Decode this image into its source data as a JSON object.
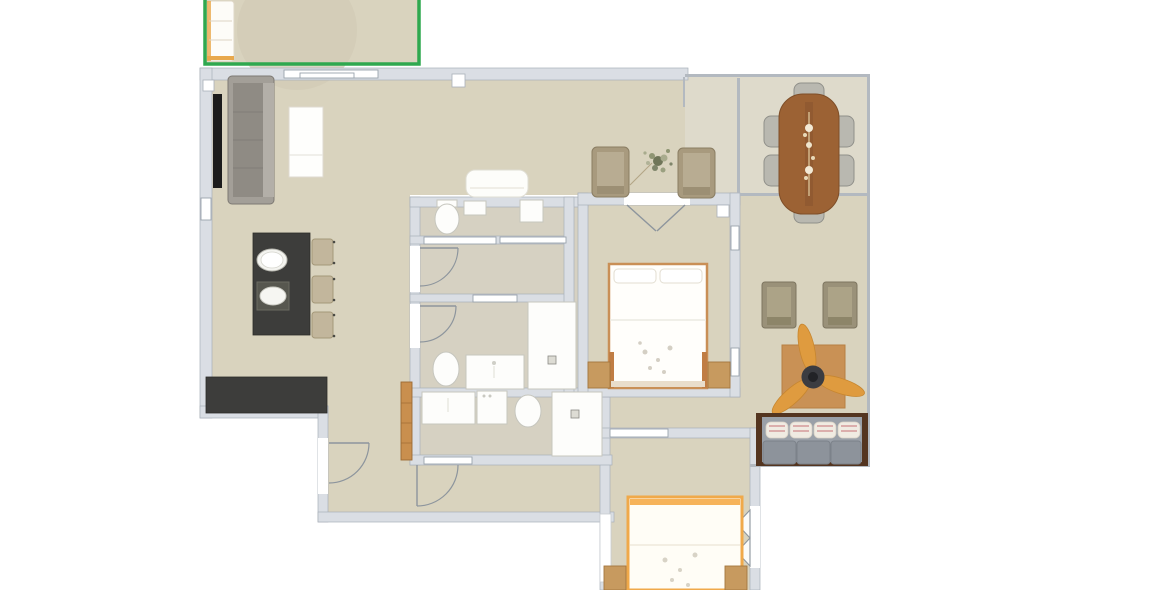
{
  "app": {
    "name": "floor-plan-editor",
    "selected_room": "balcony"
  },
  "colors": {
    "floor-main": "#d9d3be",
    "floor-dining": "#dedacb",
    "floor-bath": "#d6d1c2",
    "wall-fill": "#dadee4",
    "wall-edge": "#a9b0b9",
    "line-thin": "#b3b9c0",
    "win-edge": "#9aa3ac",
    "door-stroke": "#8d959d",
    "fixture-stroke": "#c6c6be",
    "selection-green": "#2fa84f",
    "counter-dark": "#3d3d3b",
    "tv-black": "#1c1c1c",
    "sofa-gray": "#8f8b84",
    "sofa-gray-light": "#a39f98",
    "stool-tan": "#c2b69c",
    "chair-tan": "#a89a7e",
    "chair-tan-light": "#b8ac92",
    "dining-chair": "#b9b8b0",
    "table-wood": "#9c6234",
    "wood-light": "#c79a5f",
    "wood-dark": "#a3763d",
    "rug-brown": "#c99155",
    "fan-orange": "#df9b3f",
    "fan-hub": "#3b3c41",
    "bench-frame": "#543520",
    "bench-back": "#9aa0a8",
    "cushion-gray": "#8d939b",
    "pillow-cream": "#f0ebe2",
    "pillow-stripe": "#d69e9e",
    "bed1-frame": "#c98f56",
    "bed2-frame": "#f0a94a",
    "balcony-rug": "#d2ccb6"
  },
  "rooms": [
    {
      "id": "balcony",
      "label": "Balcony",
      "selected": true,
      "furniture": [
        "lounger",
        "round-rug"
      ]
    },
    {
      "id": "living-room",
      "label": "Living / Kitchen",
      "furniture": [
        "sofa",
        "tv",
        "coffee-table",
        "loveseat",
        "kitchen-island",
        "sink",
        "cooktop",
        "bar-stools",
        "kitchen-counter",
        "armchairs",
        "plant"
      ]
    },
    {
      "id": "dining-terrace",
      "label": "Dining Area",
      "furniture": [
        "dining-table",
        "dining-chairs"
      ]
    },
    {
      "id": "bedroom-1",
      "label": "Bedroom 1",
      "furniture": [
        "double-bed",
        "nightstand-left",
        "nightstand-right"
      ]
    },
    {
      "id": "wc",
      "label": "WC",
      "furniture": [
        "toilet",
        "wall-cabinet",
        "cabinet"
      ]
    },
    {
      "id": "bathroom-1",
      "label": "Bathroom 1",
      "furniture": [
        "toilet",
        "vanity",
        "shower"
      ]
    },
    {
      "id": "bathroom-2",
      "label": "Bathroom 2",
      "furniture": [
        "vanity",
        "washer",
        "toilet",
        "shower"
      ]
    },
    {
      "id": "hallway",
      "label": "Hallway",
      "furniture": [
        "closet"
      ]
    },
    {
      "id": "lounge",
      "label": "Lounge Corner",
      "furniture": [
        "chair-1",
        "chair-2",
        "square-rug",
        "ceiling-fan",
        "daybed"
      ]
    },
    {
      "id": "bedroom-2",
      "label": "Bedroom 2",
      "furniture": [
        "double-bed",
        "nightstand-left",
        "nightstand-right",
        "window-shelf"
      ]
    }
  ]
}
